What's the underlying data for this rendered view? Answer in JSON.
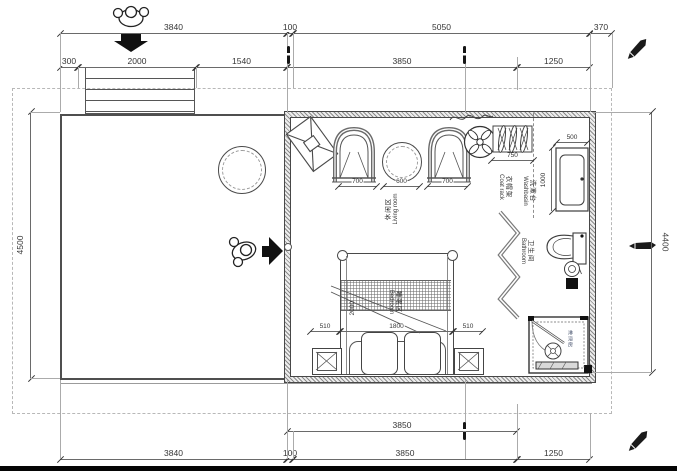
{
  "drawing": {
    "dims": {
      "top_row1": [
        "3840",
        "100",
        "5050",
        "370"
      ],
      "top_row2": [
        "300",
        "2000",
        "1540",
        "3850",
        "1250"
      ],
      "bottom_row1": [
        "3850"
      ],
      "bottom_row2": [
        "3840",
        "100",
        "3850",
        "1250"
      ],
      "left": "4500",
      "right": "4400",
      "living_row": [
        "700",
        "600",
        "700"
      ],
      "coat_rack": "750",
      "washbasin": [
        "500",
        "1000"
      ],
      "bed_row": [
        "510",
        "1800",
        "510"
      ],
      "bed_length": "2000"
    },
    "labels": {
      "living": {
        "zh": "休闲区",
        "en": "Living room"
      },
      "bedroom": {
        "zh": "睡眠区",
        "en": "Bedroom"
      },
      "bathroom": {
        "zh": "卫生间",
        "en": "Bathroom"
      },
      "washbasin": {
        "zh": "洗漱台",
        "en": "Washbasin"
      },
      "coat_rack": {
        "zh": "衣帽架",
        "en": "Coat rack"
      },
      "shower": {
        "zh": "淋浴房",
        "en": ""
      }
    },
    "icons": [
      "person-top-view-icon",
      "down-arrow-icon",
      "right-arrow-icon",
      "ceiling-fan-icon",
      "pen-marker-icon",
      "level-pole-icon",
      "hanger-icon",
      "paper-roll-icon"
    ],
    "colors": {
      "line": "#4a4a4a",
      "dim_text": "#353535",
      "hatch": "#8b8b8b",
      "boundary": "#b8b8b8",
      "black": "#111111"
    }
  }
}
